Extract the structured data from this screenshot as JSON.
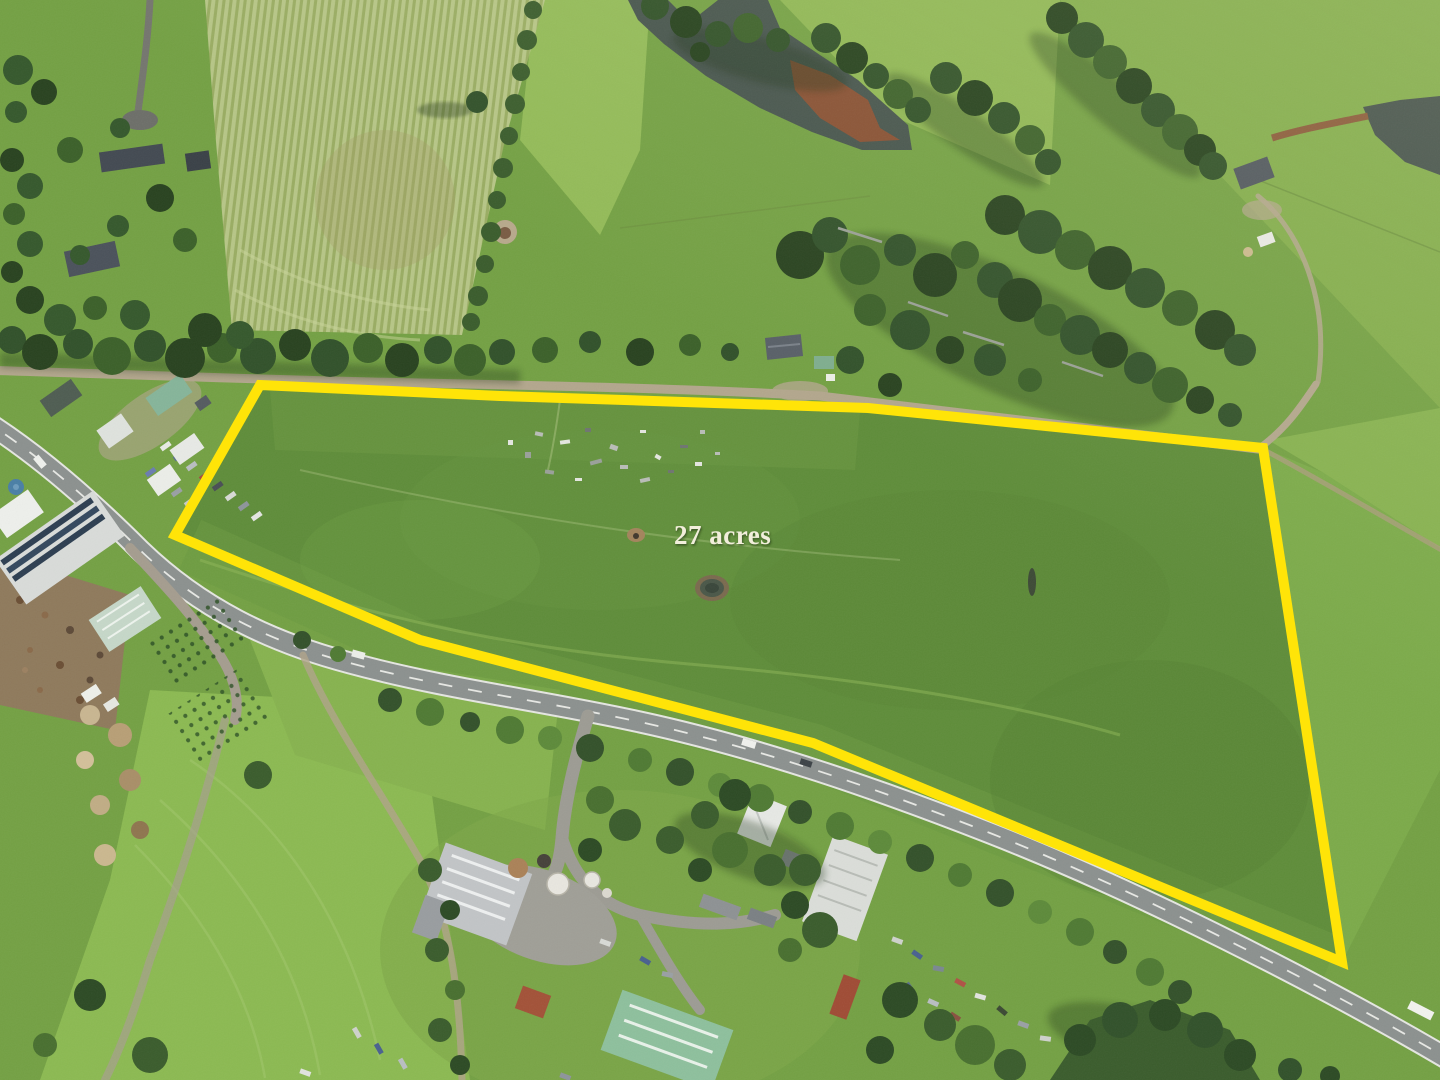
{
  "annotation": {
    "area_label": "27 acres",
    "label_color": "#f2eedb",
    "label_x": "674",
    "label_y": "544",
    "label_font_size": "27",
    "boundary_color": "#ffe408",
    "boundary_stroke_width": "10",
    "boundary_points": "260,385 500,396 868,408 1263,448 1342,962 813,743 420,640 175,535"
  },
  "scene": {
    "type": "aerial-drone-photo",
    "subject": "27 acre farmland parcel outlined in yellow",
    "features": [
      "property-boundary",
      "grazing-paddock",
      "highway",
      "gravel-road",
      "farm-pond",
      "stock-dam",
      "striped-crop-field",
      "tree-windbreaks",
      "farm-sheds",
      "plant-nursery",
      "rural-houses",
      "junk-yard"
    ],
    "palette": {
      "pasture": "#74a144",
      "property_grass": "#5f8d3a",
      "bright_field": "#8cba52",
      "striped_field_light": "#b7c687",
      "striped_field_dark": "#9aad63",
      "trees_dark": "#31512a",
      "water": "#46544d",
      "pond_sediment": "#94502f",
      "asphalt": "#8c918f",
      "gravel": "#b3a78d",
      "roof_white": "#e8eae6",
      "roof_grey": "#4a5058",
      "roof_green": "#8ec09d"
    }
  }
}
